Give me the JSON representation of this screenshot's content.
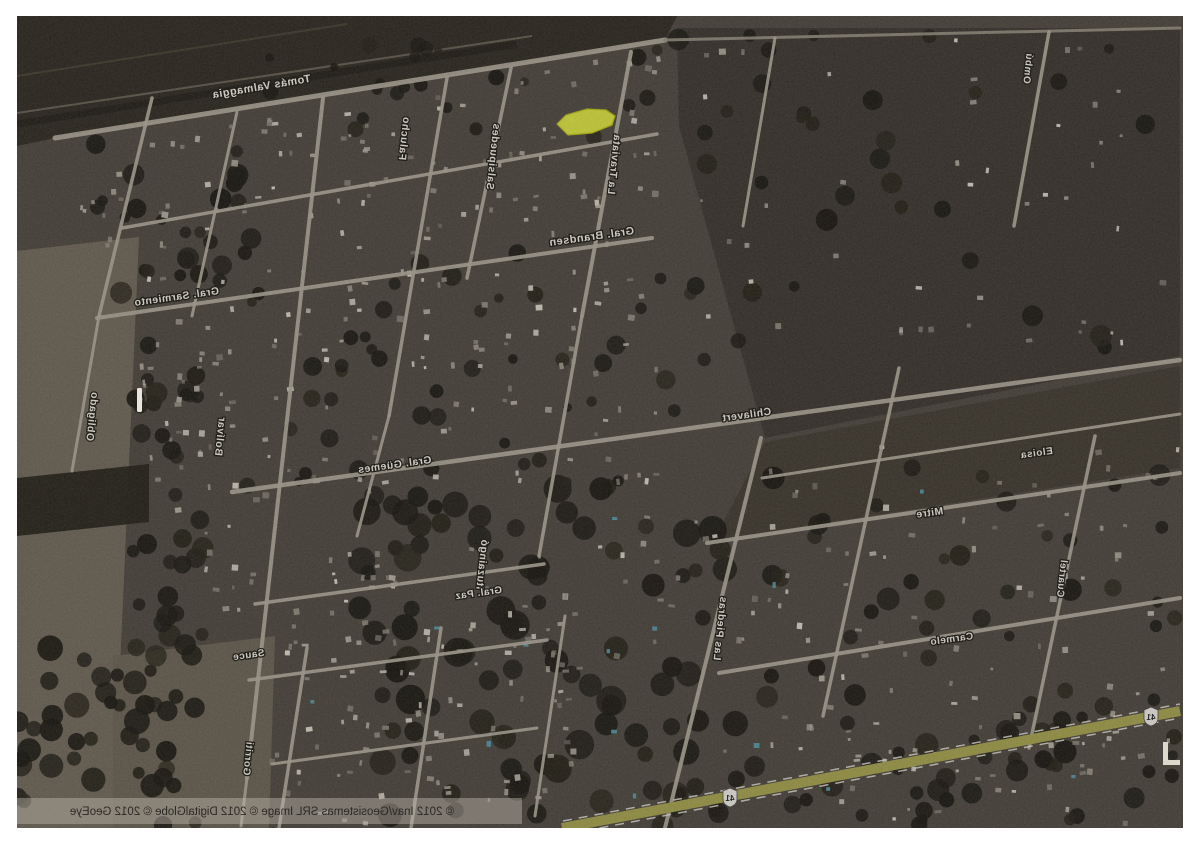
{
  "window": {
    "width": 1200,
    "height": 855,
    "background": "#ffffff"
  },
  "map": {
    "x": 17,
    "y": 16,
    "w": 1166,
    "h": 812,
    "description": "mirrored satellite aerial view of a small grid town with highlighted lot",
    "palette": {
      "base": "#49433b",
      "road": "#b5ae9f",
      "route_yellow": "#a7a34a",
      "highlight_fill": "#eaf23b",
      "highlight_stroke": "#c3c708",
      "label_fill": "#f6f3e9",
      "label_stroke": "#15120b",
      "woods": "#14110b",
      "field_light": "#6e6557"
    },
    "terrain": [
      {
        "pts": "0,0 660,0 648,24 38,122 0,130",
        "fill": "#29241c",
        "op": 1
      },
      {
        "pts": "0,235 122,221 96,812 0,812",
        "fill": "#6e6557",
        "op": 1
      },
      {
        "pts": "96,640 258,620 252,812 96,812",
        "fill": "#675f51",
        "op": 1
      },
      {
        "pts": "0,462 132,448 132,506 0,520",
        "fill": "#1f1b13",
        "op": 0.95
      },
      {
        "pts": "660,12 1163,12 1163,340 748,422 662,110",
        "fill": "#36302a",
        "op": 1
      },
      {
        "pts": "748,426 1163,350 1163,452 697,524",
        "fill": "#3b352b",
        "op": 1
      }
    ],
    "underlines": [
      {
        "x1": 0,
        "y1": 108,
        "x2": 500,
        "y2": 28,
        "w": 7,
        "c": "#1d1812",
        "op": 1
      },
      {
        "x1": 0,
        "y1": 97,
        "x2": 515,
        "y2": 20,
        "w": 2,
        "c": "#6a6254",
        "op": 0.9
      },
      {
        "x1": 0,
        "y1": 60,
        "x2": 330,
        "y2": 8,
        "w": 2,
        "c": "#59523f",
        "op": 0.5
      }
    ],
    "woods": [
      {
        "x": 340,
        "y": 470,
        "w": 390,
        "h": 330,
        "n": 95,
        "rmin": 7,
        "rmax": 15,
        "seed": 11
      },
      {
        "x": 116,
        "y": 325,
        "w": 70,
        "h": 487,
        "n": 50,
        "rmin": 6,
        "rmax": 12,
        "seed": 22
      },
      {
        "x": 70,
        "y": 125,
        "w": 180,
        "h": 160,
        "n": 28,
        "rmin": 5,
        "rmax": 11,
        "seed": 33
      },
      {
        "x": 0,
        "y": 630,
        "w": 120,
        "h": 182,
        "n": 26,
        "rmin": 6,
        "rmax": 13,
        "seed": 44
      },
      {
        "x": 740,
        "y": 430,
        "w": 423,
        "h": 380,
        "n": 55,
        "rmin": 5,
        "rmax": 12,
        "seed": 55
      },
      {
        "x": 660,
        "y": 18,
        "w": 500,
        "h": 320,
        "n": 32,
        "rmin": 5,
        "rmax": 11,
        "seed": 66
      },
      {
        "x": 230,
        "y": 28,
        "w": 420,
        "h": 105,
        "n": 24,
        "rmin": 4,
        "rmax": 9,
        "seed": 77
      },
      {
        "x": 230,
        "y": 230,
        "w": 510,
        "h": 240,
        "n": 48,
        "rmin": 4,
        "rmax": 10,
        "seed": 88
      },
      {
        "x": 640,
        "y": 700,
        "w": 520,
        "h": 110,
        "n": 30,
        "rmin": 5,
        "rmax": 12,
        "seed": 99
      }
    ],
    "speckles": [
      {
        "x": 55,
        "y": 38,
        "w": 585,
        "h": 195,
        "n": 150,
        "seed": 5,
        "belowLine": [
          38,
          122,
          648,
          24
        ]
      },
      {
        "x": 120,
        "y": 235,
        "w": 520,
        "h": 235,
        "n": 110,
        "seed": 6
      },
      {
        "x": 230,
        "y": 470,
        "w": 510,
        "h": 180,
        "n": 55,
        "seed": 7
      },
      {
        "x": 250,
        "y": 600,
        "w": 310,
        "h": 205,
        "n": 85,
        "seed": 8
      },
      {
        "x": 740,
        "y": 420,
        "w": 423,
        "h": 280,
        "n": 65,
        "seed": 9
      },
      {
        "x": 660,
        "y": 22,
        "w": 500,
        "h": 315,
        "n": 45,
        "seed": 10
      },
      {
        "x": 640,
        "y": 700,
        "w": 520,
        "h": 105,
        "n": 45,
        "seed": 12
      },
      {
        "x": 118,
        "y": 330,
        "w": 112,
        "h": 290,
        "n": 30,
        "seed": 13
      }
    ],
    "pools": {
      "x": 250,
      "y": 470,
      "w": 860,
      "h": 330,
      "n": 14,
      "seed": 14,
      "c": "#57a0b5"
    },
    "roads": [
      {
        "x1": 38,
        "y1": 122,
        "x2": 648,
        "y2": 24,
        "w": 5
      },
      {
        "x1": 648,
        "y1": 24,
        "x2": 1163,
        "y2": 12,
        "w": 3,
        "c": "#968f80"
      },
      {
        "x1": 105,
        "y1": 212,
        "x2": 640,
        "y2": 118,
        "w": 3.5
      },
      {
        "x1": 80,
        "y1": 302,
        "x2": 635,
        "y2": 222,
        "w": 4
      },
      {
        "x1": 215,
        "y1": 476,
        "x2": 1163,
        "y2": 344,
        "w": 4.5
      },
      {
        "x1": 238,
        "y1": 588,
        "x2": 527,
        "y2": 548,
        "w": 3.5
      },
      {
        "x1": 232,
        "y1": 664,
        "x2": 530,
        "y2": 624,
        "w": 3.5
      },
      {
        "x1": 690,
        "y1": 527,
        "x2": 1163,
        "y2": 457,
        "w": 4
      },
      {
        "x1": 745,
        "y1": 462,
        "x2": 1163,
        "y2": 398,
        "w": 3
      },
      {
        "x1": 702,
        "y1": 657,
        "x2": 1163,
        "y2": 582,
        "w": 4
      },
      {
        "x1": 255,
        "y1": 748,
        "x2": 520,
        "y2": 712,
        "w": 3
      },
      {
        "x1": 135,
        "y1": 82,
        "x2": 82,
        "y2": 300,
        "w": 3.5
      },
      {
        "x1": 82,
        "y1": 300,
        "x2": 55,
        "y2": 455,
        "w": 3
      },
      {
        "x1": 306,
        "y1": 82,
        "x2": 230,
        "y2": 762,
        "w": 4
      },
      {
        "x1": 230,
        "y1": 762,
        "x2": 224,
        "y2": 810,
        "w": 3
      },
      {
        "x1": 220,
        "y1": 96,
        "x2": 175,
        "y2": 300,
        "w": 3
      },
      {
        "x1": 430,
        "y1": 62,
        "x2": 372,
        "y2": 400,
        "w": 3.5
      },
      {
        "x1": 372,
        "y1": 400,
        "x2": 340,
        "y2": 520,
        "w": 3
      },
      {
        "x1": 494,
        "y1": 52,
        "x2": 450,
        "y2": 262,
        "w": 3.5
      },
      {
        "x1": 614,
        "y1": 36,
        "x2": 565,
        "y2": 300,
        "w": 4
      },
      {
        "x1": 565,
        "y1": 300,
        "x2": 522,
        "y2": 540,
        "w": 3.5
      },
      {
        "x1": 744,
        "y1": 422,
        "x2": 648,
        "y2": 812,
        "w": 4
      },
      {
        "x1": 882,
        "y1": 352,
        "x2": 806,
        "y2": 700,
        "w": 3.5
      },
      {
        "x1": 1078,
        "y1": 420,
        "x2": 1012,
        "y2": 732,
        "w": 3.5
      },
      {
        "x1": 758,
        "y1": 22,
        "x2": 726,
        "y2": 210,
        "w": 3
      },
      {
        "x1": 1032,
        "y1": 16,
        "x2": 997,
        "y2": 210,
        "w": 3.5
      },
      {
        "x1": 290,
        "y1": 632,
        "x2": 262,
        "y2": 812,
        "w": 3.5
      },
      {
        "x1": 424,
        "y1": 612,
        "x2": 394,
        "y2": 812,
        "w": 3.5
      },
      {
        "x1": 548,
        "y1": 600,
        "x2": 518,
        "y2": 800,
        "w": 3
      }
    ],
    "route": {
      "x1": 545,
      "y1": 812,
      "x2": 1163,
      "y2": 695,
      "w": 10,
      "c": "#a7a34a",
      "edges": [
        {
          "x1": 546,
          "y1": 805,
          "x2": 1163,
          "y2": 688
        },
        {
          "x1": 551,
          "y1": 818,
          "x2": 1163,
          "y2": 702
        }
      ],
      "edge_color": "#eceadb",
      "shields": [
        {
          "x": 713,
          "y": 781
        },
        {
          "x": 1134,
          "y": 700
        }
      ],
      "shield_number": "41"
    },
    "highlight": {
      "pts": "540,108 549,99 570,93 589,94 598,100 595,109 575,117 551,119",
      "fill": "#eaf23b",
      "stroke": "#c3c708"
    },
    "labels": [
      {
        "t": "Tomás Valmaggia",
        "x": 245,
        "y": 74,
        "a": -9.5,
        "s": 11
      },
      {
        "t": "Falucho",
        "x": 384,
        "y": 122,
        "a": 96,
        "s": 10.5
      },
      {
        "t": "Salsipuedes",
        "x": 473,
        "y": 140,
        "a": 96,
        "s": 10.5
      },
      {
        "t": "La Traviata",
        "x": 594,
        "y": 148,
        "a": 96,
        "s": 10.5
      },
      {
        "t": "Gral. Brandsen",
        "x": 575,
        "y": 224,
        "a": -8,
        "s": 11
      },
      {
        "t": "Gral. Sarmiento",
        "x": 160,
        "y": 284,
        "a": -8,
        "s": 10.5
      },
      {
        "t": "Bolívar",
        "x": 200,
        "y": 420,
        "a": 96,
        "s": 10.5
      },
      {
        "t": "Obligado",
        "x": 72,
        "y": 400,
        "a": 96,
        "s": 10.5
      },
      {
        "t": "Gral. Güemes",
        "x": 378,
        "y": 452,
        "a": -8,
        "s": 10.5
      },
      {
        "t": "Chilavert",
        "x": 730,
        "y": 402,
        "a": -8,
        "s": 10.5
      },
      {
        "t": "Ituzaingó",
        "x": 462,
        "y": 548,
        "a": 96,
        "s": 10.5
      },
      {
        "t": "Las Piedras",
        "x": 700,
        "y": 612,
        "a": 96,
        "s": 10.5
      },
      {
        "t": "Mitre",
        "x": 913,
        "y": 500,
        "a": -8,
        "s": 10.5
      },
      {
        "t": "Eloisa",
        "x": 1020,
        "y": 440,
        "a": -8,
        "s": 10
      },
      {
        "t": "Cuartel",
        "x": 1042,
        "y": 562,
        "a": 96,
        "s": 10
      },
      {
        "t": "Carmelo",
        "x": 935,
        "y": 626,
        "a": -8,
        "s": 10
      },
      {
        "t": "Sauce",
        "x": 232,
        "y": 642,
        "a": -8,
        "s": 10
      },
      {
        "t": "Gorriti",
        "x": 228,
        "y": 742,
        "a": 96,
        "s": 10
      },
      {
        "t": "Ombú",
        "x": 1008,
        "y": 52,
        "a": 96,
        "s": 10
      },
      {
        "t": "Gral. Paz",
        "x": 462,
        "y": 580,
        "a": -8,
        "s": 10
      }
    ],
    "attribution": {
      "text": "© 2012 Inav/Geosistemas SRL    Image © 2012 DigitalGlobe    © 2012 GeoEye",
      "x": 245,
      "y": 799,
      "s": 11.5,
      "band": {
        "x": 0,
        "y": 782,
        "w": 505,
        "h": 26,
        "fill": "#beb8ac",
        "op": 0.45
      }
    },
    "marks": [
      {
        "type": "rect",
        "x": 120,
        "y": 372,
        "w": 5,
        "h": 24,
        "fill": "#e8e5da",
        "name": "white-pole"
      },
      {
        "type": "path",
        "d": "M1146,726 h5 v18 h12 v5 h-17 z",
        "fill": "#dcd8cb",
        "name": "edge-mark"
      }
    ]
  }
}
